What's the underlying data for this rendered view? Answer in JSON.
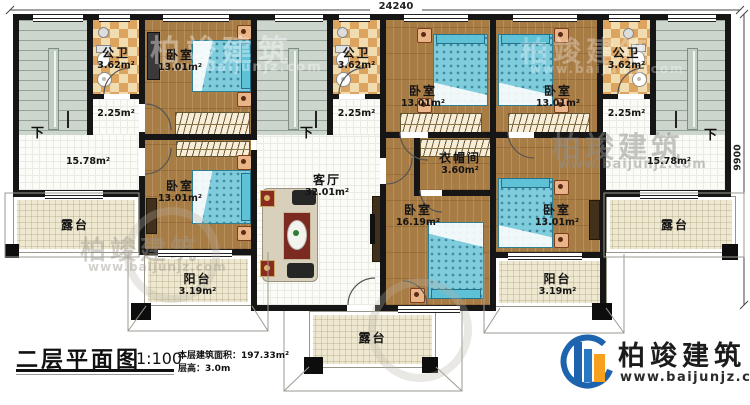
{
  "dimensions": {
    "top": "24240",
    "right": "9900"
  },
  "title_block": {
    "title": "二层平面图",
    "scale": "1:100",
    "floor_area": "本层建筑面积：197.33m²",
    "floor_height": "层高：3.0m"
  },
  "logo": {
    "brand": "柏竣建筑",
    "url": "www.baijunjz.com"
  },
  "watermark": {
    "brand": "柏竣建筑",
    "url": "www.baijunjz.com"
  },
  "stairs": {
    "down": "下"
  },
  "rooms": {
    "bath_left": {
      "name": "公卫",
      "area": "3.62m²"
    },
    "hall_left": {
      "area": "2.25m²"
    },
    "bed_top_left": {
      "name": "卧室",
      "area": "13.01m²"
    },
    "open_left": {
      "area": "15.78m²"
    },
    "terrace_left": {
      "name": "露台"
    },
    "bed_mid_left": {
      "name": "卧室",
      "area": "13.01m²"
    },
    "balcony_left": {
      "name": "阳台",
      "area": "3.19m²"
    },
    "bath_mid": {
      "name": "公卫",
      "area": "3.62m²"
    },
    "hall_mid": {
      "area": "2.25m²"
    },
    "living": {
      "name": "客厅",
      "area": "32.01m²"
    },
    "bed_top_mid_left": {
      "name": "卧室",
      "area": "13.01m²"
    },
    "bed_top_mid_right": {
      "name": "卧室",
      "area": "13.01m²"
    },
    "cloakroom": {
      "name": "衣帽间",
      "area": "3.60m²"
    },
    "bed_center": {
      "name": "卧室",
      "area": "16.19m²"
    },
    "bed_mid_right": {
      "name": "卧室",
      "area": "13.01m²"
    },
    "bath_right": {
      "name": "公卫",
      "area": "3.62m²"
    },
    "hall_right": {
      "area": "2.25m²"
    },
    "open_right": {
      "area": "15.78m²"
    },
    "terrace_right": {
      "name": "露台"
    },
    "balcony_right": {
      "name": "阳台",
      "area": "3.19m²"
    },
    "terrace_bottom": {
      "name": "露台"
    }
  },
  "colors": {
    "wall": "#161616",
    "wood_floor": "#a87c45",
    "bed_teal": "#7fccdd",
    "tile_light": "#f0dcae",
    "tile_dark": "#dca45f",
    "stair_gray": "#ccd6cd",
    "terrace_beige": "#eee8d0",
    "logo_blue": "#1e63ad",
    "logo_orange": "#f6a01e"
  }
}
